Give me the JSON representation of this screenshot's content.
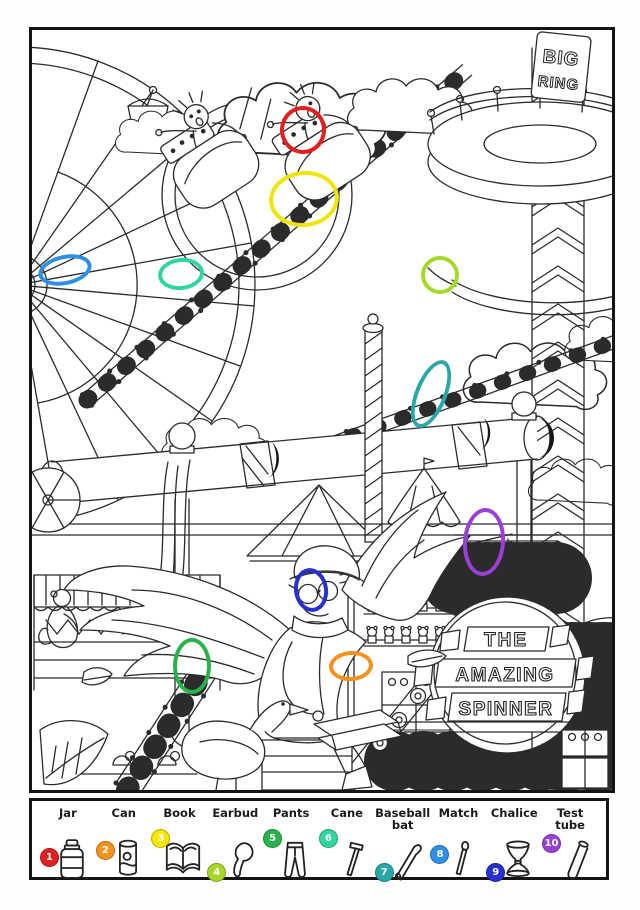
{
  "page": {
    "type": "hidden-objects coloring page",
    "theme": "amusement park"
  },
  "scene": {
    "tower_sign": [
      "BIG",
      "RING"
    ],
    "spinner_sign": [
      "THE",
      "AMAZING",
      "SPINNER"
    ],
    "line_color": "#2b2b2b"
  },
  "markers": [
    {
      "number": 1,
      "item": "jar",
      "color": "#e02020",
      "cx": 271,
      "cy": 100,
      "rx": 23,
      "ry": 24,
      "rot": 0
    },
    {
      "number": 3,
      "item": "book",
      "color": "#f0e40a",
      "cx": 272,
      "cy": 169,
      "rx": 35,
      "ry": 28,
      "rot": -6
    },
    {
      "number": 8,
      "item": "match",
      "color": "#2e8fe6",
      "cx": 33,
      "cy": 240,
      "rx": 27,
      "ry": 15,
      "rot": -12
    },
    {
      "number": 6,
      "item": "cane",
      "color": "#2fd6a0",
      "cx": 149,
      "cy": 244,
      "rx": 23,
      "ry": 16,
      "rot": -6
    },
    {
      "number": 4,
      "item": "earbud",
      "color": "#a6d829",
      "cx": 408,
      "cy": 245,
      "rx": 19,
      "ry": 19,
      "rot": 0
    },
    {
      "number": 7,
      "item": "baseball-bat",
      "color": "#2aa7a7",
      "cx": 399,
      "cy": 364,
      "rx": 16,
      "ry": 36,
      "rot": 22
    },
    {
      "number": 10,
      "item": "test-tube",
      "color": "#9b3fd6",
      "cx": 452,
      "cy": 512,
      "rx": 21,
      "ry": 34,
      "rot": 4
    },
    {
      "number": 9,
      "item": "chalice",
      "color": "#2a2fd1",
      "cx": 279,
      "cy": 560,
      "rx": 17,
      "ry": 22,
      "rot": -8
    },
    {
      "number": 5,
      "item": "pants",
      "color": "#28b24b",
      "cx": 160,
      "cy": 636,
      "rx": 19,
      "ry": 28,
      "rot": 0
    },
    {
      "number": 2,
      "item": "can",
      "color": "#f5921e",
      "cx": 319,
      "cy": 636,
      "rx": 22,
      "ry": 15,
      "rot": -4
    }
  ],
  "legend": {
    "items": [
      {
        "number": 1,
        "label": "Jar",
        "label2": "",
        "color": "#e02020",
        "icon": "jar-icon"
      },
      {
        "number": 2,
        "label": "Can",
        "label2": "",
        "color": "#f5921e",
        "icon": "can-icon"
      },
      {
        "number": 3,
        "label": "Book",
        "label2": "",
        "color": "#f6e800",
        "icon": "book-icon"
      },
      {
        "number": 4,
        "label": "Earbud",
        "label2": "",
        "color": "#a6d829",
        "icon": "earbud-icon"
      },
      {
        "number": 5,
        "label": "Pants",
        "label2": "",
        "color": "#28b24b",
        "icon": "pants-icon"
      },
      {
        "number": 6,
        "label": "Cane",
        "label2": "",
        "color": "#2fd6a0",
        "icon": "cane-icon"
      },
      {
        "number": 7,
        "label": "Baseball",
        "label2": "bat",
        "color": "#2aa7a7",
        "icon": "baseball-bat-icon"
      },
      {
        "number": 8,
        "label": "Match",
        "label2": "",
        "color": "#2e8fe6",
        "icon": "match-icon"
      },
      {
        "number": 9,
        "label": "Chalice",
        "label2": "",
        "color": "#2a2fd1",
        "icon": "chalice-icon"
      },
      {
        "number": 10,
        "label": "Test",
        "label2": "tube",
        "color": "#9b3fd6",
        "icon": "test-tube-icon"
      }
    ]
  }
}
